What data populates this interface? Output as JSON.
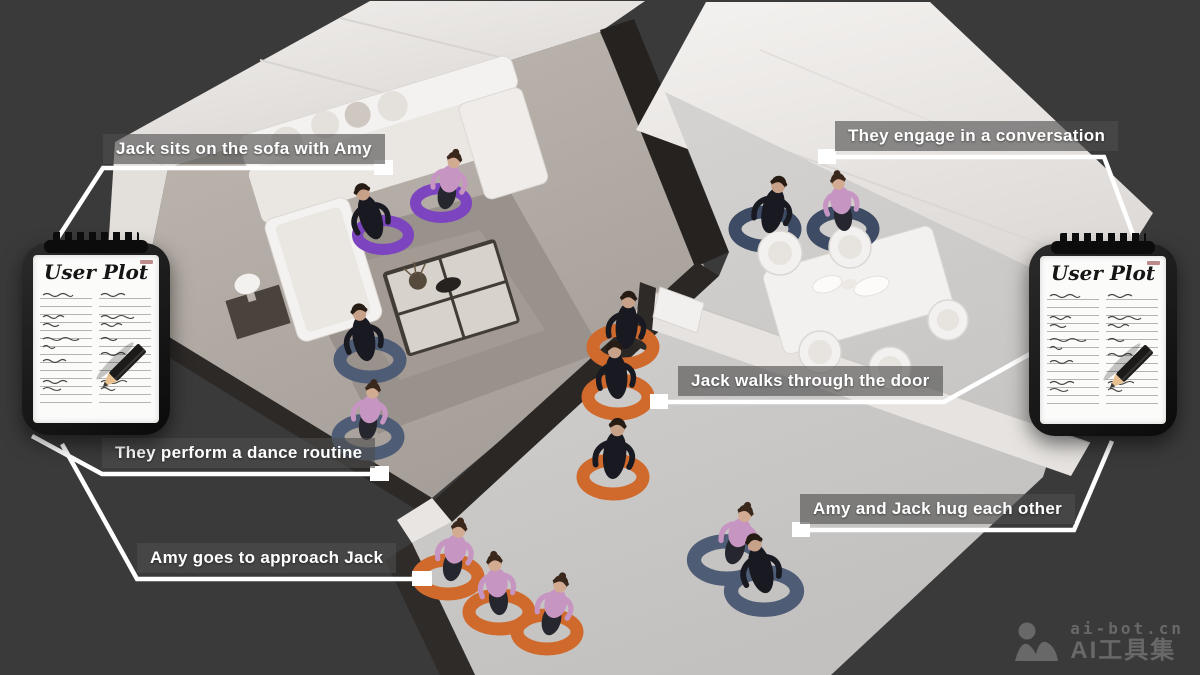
{
  "annotations": [
    {
      "id": "sofa",
      "text": "Jack sits on the sofa with Amy"
    },
    {
      "id": "conversation",
      "text": "They engage in a conversation"
    },
    {
      "id": "door",
      "text": "Jack walks through the door"
    },
    {
      "id": "dance",
      "text": "They perform a dance routine"
    },
    {
      "id": "approach",
      "text": "Amy goes to approach Jack"
    },
    {
      "id": "hug",
      "text": "Amy and Jack hug each other"
    }
  ],
  "clipboard": {
    "title": "User Plot"
  },
  "watermark": {
    "site": "ai-bot.cn",
    "brand": "AI工具集"
  },
  "scene": {
    "characters": [
      "Jack",
      "Amy"
    ],
    "activity_markers": [
      {
        "activity": "sitting on sofa",
        "ring_color": "#7d44c0"
      },
      {
        "activity": "dance routine",
        "ring_color": "#4e5c76"
      },
      {
        "activity": "conversation",
        "ring_color": "#3d4b64"
      },
      {
        "activity": "walking through door",
        "ring_color": "#d06a2c"
      },
      {
        "activity": "approaching",
        "ring_color": "#d06a2c"
      },
      {
        "activity": "hugging",
        "ring_color": "#4e5c76"
      }
    ]
  },
  "colors": {
    "background": "#3b3a3a",
    "ring_orange": "#d06a2c",
    "ring_purple": "#7d44c0",
    "ring_slate": "#4e5c76",
    "ring_navy": "#3d4b64",
    "jack_outfit": "#191921",
    "amy_top_pink": "#c795c2",
    "label_text": "#ffffff",
    "connector": "#ffffff",
    "watermark": "#6c6c6c"
  }
}
